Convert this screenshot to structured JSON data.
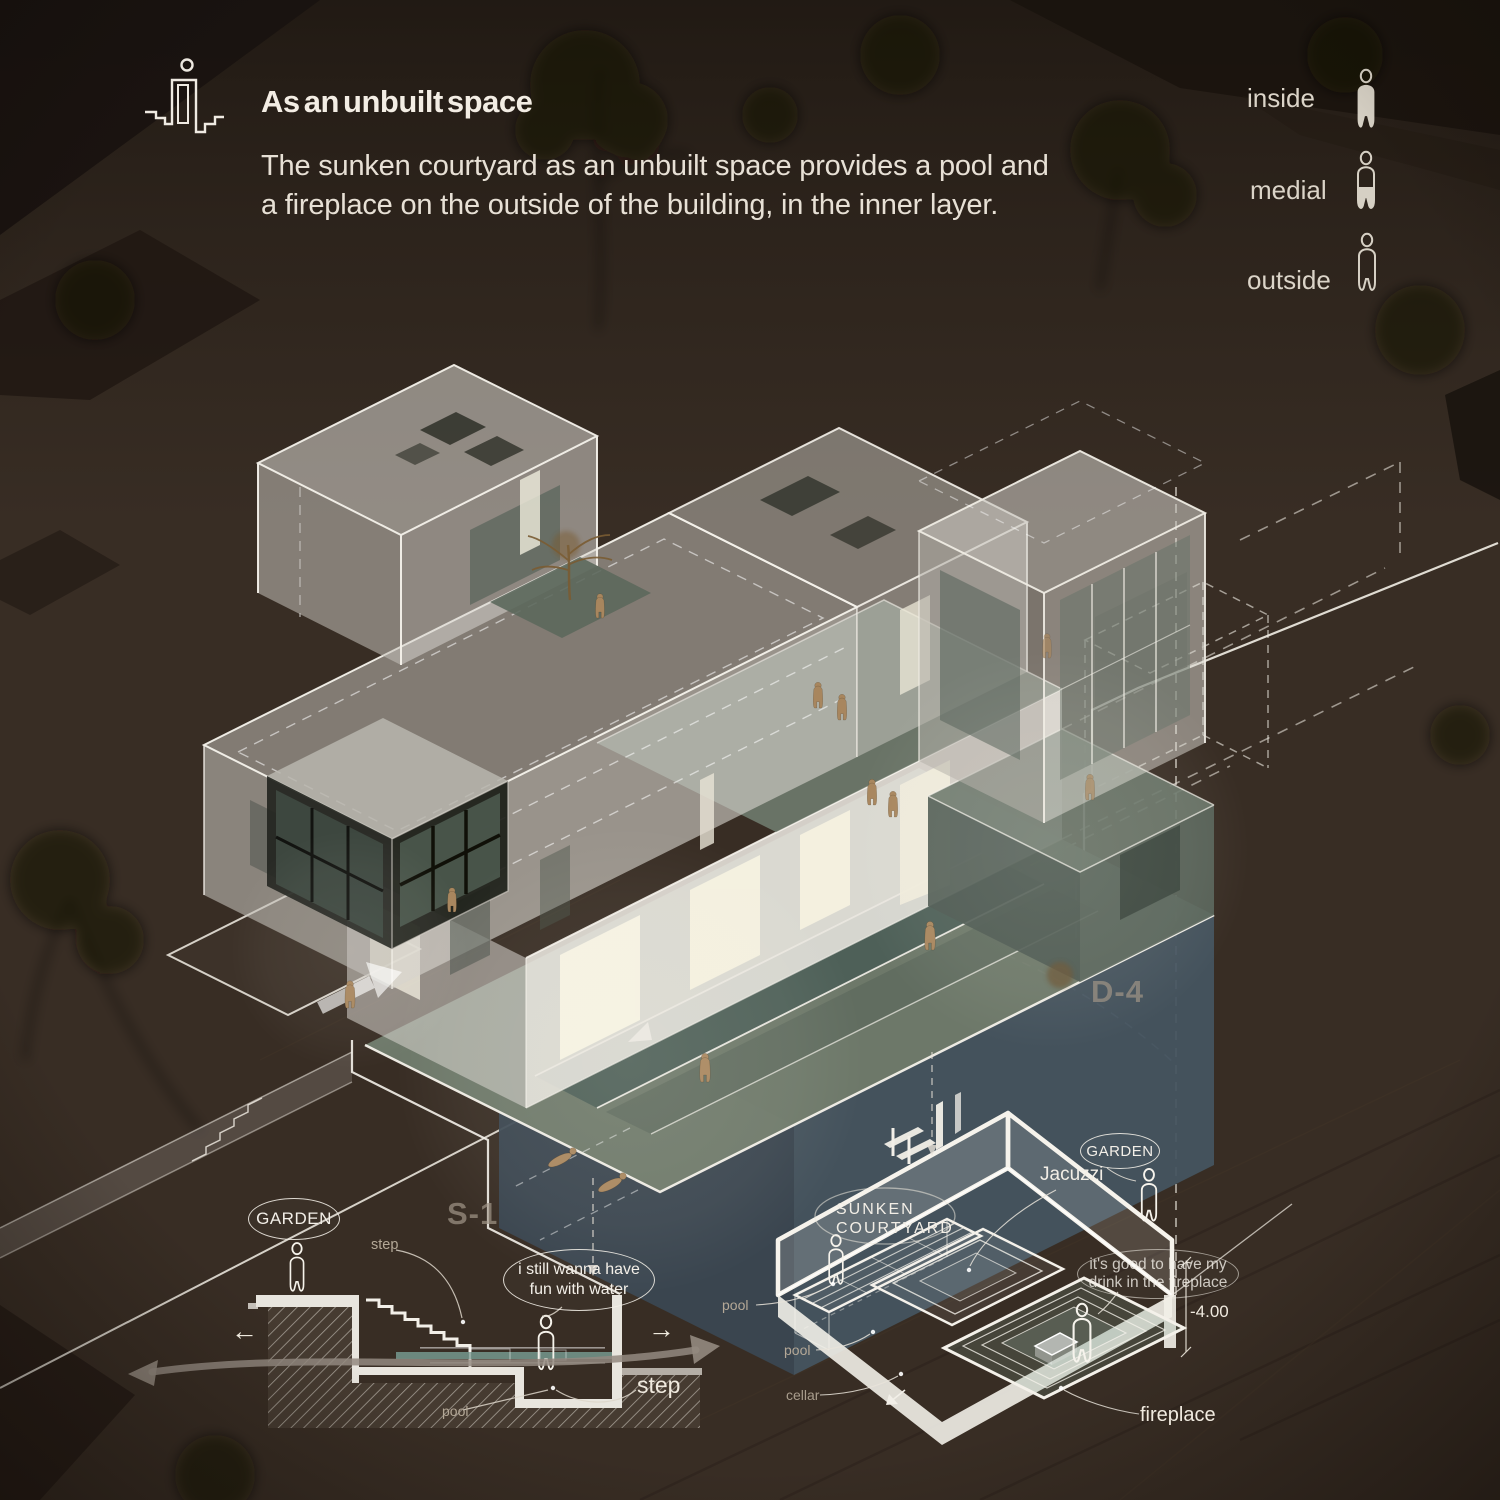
{
  "page": {
    "kind": "architecture-presentation-board",
    "scene": "night axonometric of house with sunken courtyard"
  },
  "colors": {
    "background": "#382d24",
    "line_white": "#f2eee5",
    "deck_green": "#707b6b",
    "underground_teal": "#3a4752",
    "water_teal": "#6f8d84",
    "figure_tan": "#a8865e",
    "muted_marker": "#9e9385"
  },
  "header": {
    "title": "As an unbuilt space",
    "description": "The sunken courtyard as an unbuilt space provides a pool and a fireplace on the outside of the building, in the inner layer.",
    "icon": "sunken-courtyard-section-icon"
  },
  "legend": {
    "items": [
      {
        "label": "inside",
        "icon": "person-filled-icon"
      },
      {
        "label": "medial",
        "icon": "person-half-filled-icon"
      },
      {
        "label": "outside",
        "icon": "person-outline-icon"
      }
    ]
  },
  "axonometric": {
    "section_marker": "S-1",
    "detail_marker": "D-4"
  },
  "section_detail": {
    "garden_label": "GARDEN",
    "step_label_small": "step",
    "step_label_large": "step",
    "pool_label": "pool",
    "arrow_left": "←",
    "arrow_right": "→",
    "speech_bubble_lines": [
      "i still wanna have",
      "fun with water"
    ]
  },
  "courtyard_detail": {
    "garden_label": "GARDEN",
    "jacuzzi_label": "Jacuzzi",
    "sunken_courtyard_lines": [
      "SUNKEN",
      "COURTYARD"
    ],
    "speech_bubble_lines": [
      "it's good to have my",
      "drink in the fireplace"
    ],
    "level_label": "-4.00",
    "fireplace_label": "fireplace",
    "pool_label_upper": "pool",
    "pool_label_lower": "pool",
    "cellar_label": "cellar"
  }
}
